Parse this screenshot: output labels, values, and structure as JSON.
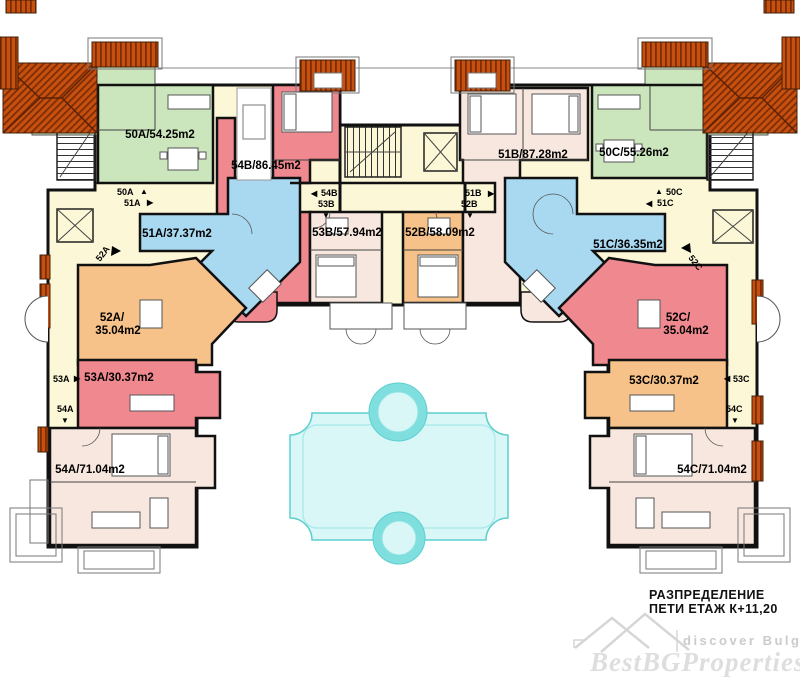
{
  "colors": {
    "green": "#cbe5bd",
    "red": "#f0898f",
    "pink": "#f8e7de",
    "orange": "#f6c289",
    "blue": "#a9d9f1",
    "cream": "#fcf8d7",
    "pool_fill": "#d9f7f6",
    "pool_ring": "#7fdede",
    "pool_line": "#5fcfcf",
    "roof": "#c7500f",
    "roof_dark": "#7c2d06",
    "wall": "#111111",
    "watermark_brand": "#dedede",
    "watermark_caption": "#cbcbcb"
  },
  "units": [
    {
      "id": "50A",
      "label": "50A/54.25m2",
      "color_key": "green"
    },
    {
      "id": "51A",
      "label": "51A/37.37m2",
      "color_key": "blue"
    },
    {
      "id": "52A",
      "label_line1": "52A/",
      "label_line2": "35.04m2",
      "color_key": "orange"
    },
    {
      "id": "53A",
      "label": "53A/30.37m2",
      "color_key": "red"
    },
    {
      "id": "54A",
      "label": "54A/71.04m2",
      "color_key": "pink"
    },
    {
      "id": "54B",
      "label": "54B/86.45m2",
      "color_key": "red"
    },
    {
      "id": "53B",
      "label": "53B/57.94m2",
      "color_key": "pink"
    },
    {
      "id": "52B",
      "label": "52B/58.09m2",
      "color_key": "orange"
    },
    {
      "id": "51B",
      "label": "51B/87.28m2",
      "color_key": "pink"
    },
    {
      "id": "50C",
      "label": "50C/55.26m2",
      "color_key": "green"
    },
    {
      "id": "51C",
      "label": "51C/36.35m2",
      "color_key": "blue"
    },
    {
      "id": "52C",
      "label_line1": "52C/",
      "label_line2": "35.04m2",
      "color_key": "red"
    },
    {
      "id": "53C",
      "label": "53C/30.37m2",
      "color_key": "orange"
    },
    {
      "id": "54C",
      "label": "54C/71.04m2",
      "color_key": "pink"
    }
  ],
  "markers": {
    "u50A": "50A",
    "u51A": "51A",
    "u52A": "52A",
    "u53A": "53A",
    "u54A": "54A",
    "u54B": "54B",
    "u53B": "53B",
    "u51B": "51B",
    "u52B": "52B",
    "u50C": "50C",
    "u51C": "51C",
    "u52C": "52C",
    "u53C": "53C",
    "u54C": "54C",
    "arrow_up": "▲",
    "arrow_down": "▼",
    "arrow_left": "◀",
    "arrow_right": "▶"
  },
  "title_block": {
    "line1": "РАЗПРЕДЕЛЕНИЕ",
    "line2": "ПЕТИ ЕТАЖ  К+11,20"
  },
  "watermark": {
    "logo_caption": "discover Bulgaria",
    "brand": "BestBGProperties"
  }
}
